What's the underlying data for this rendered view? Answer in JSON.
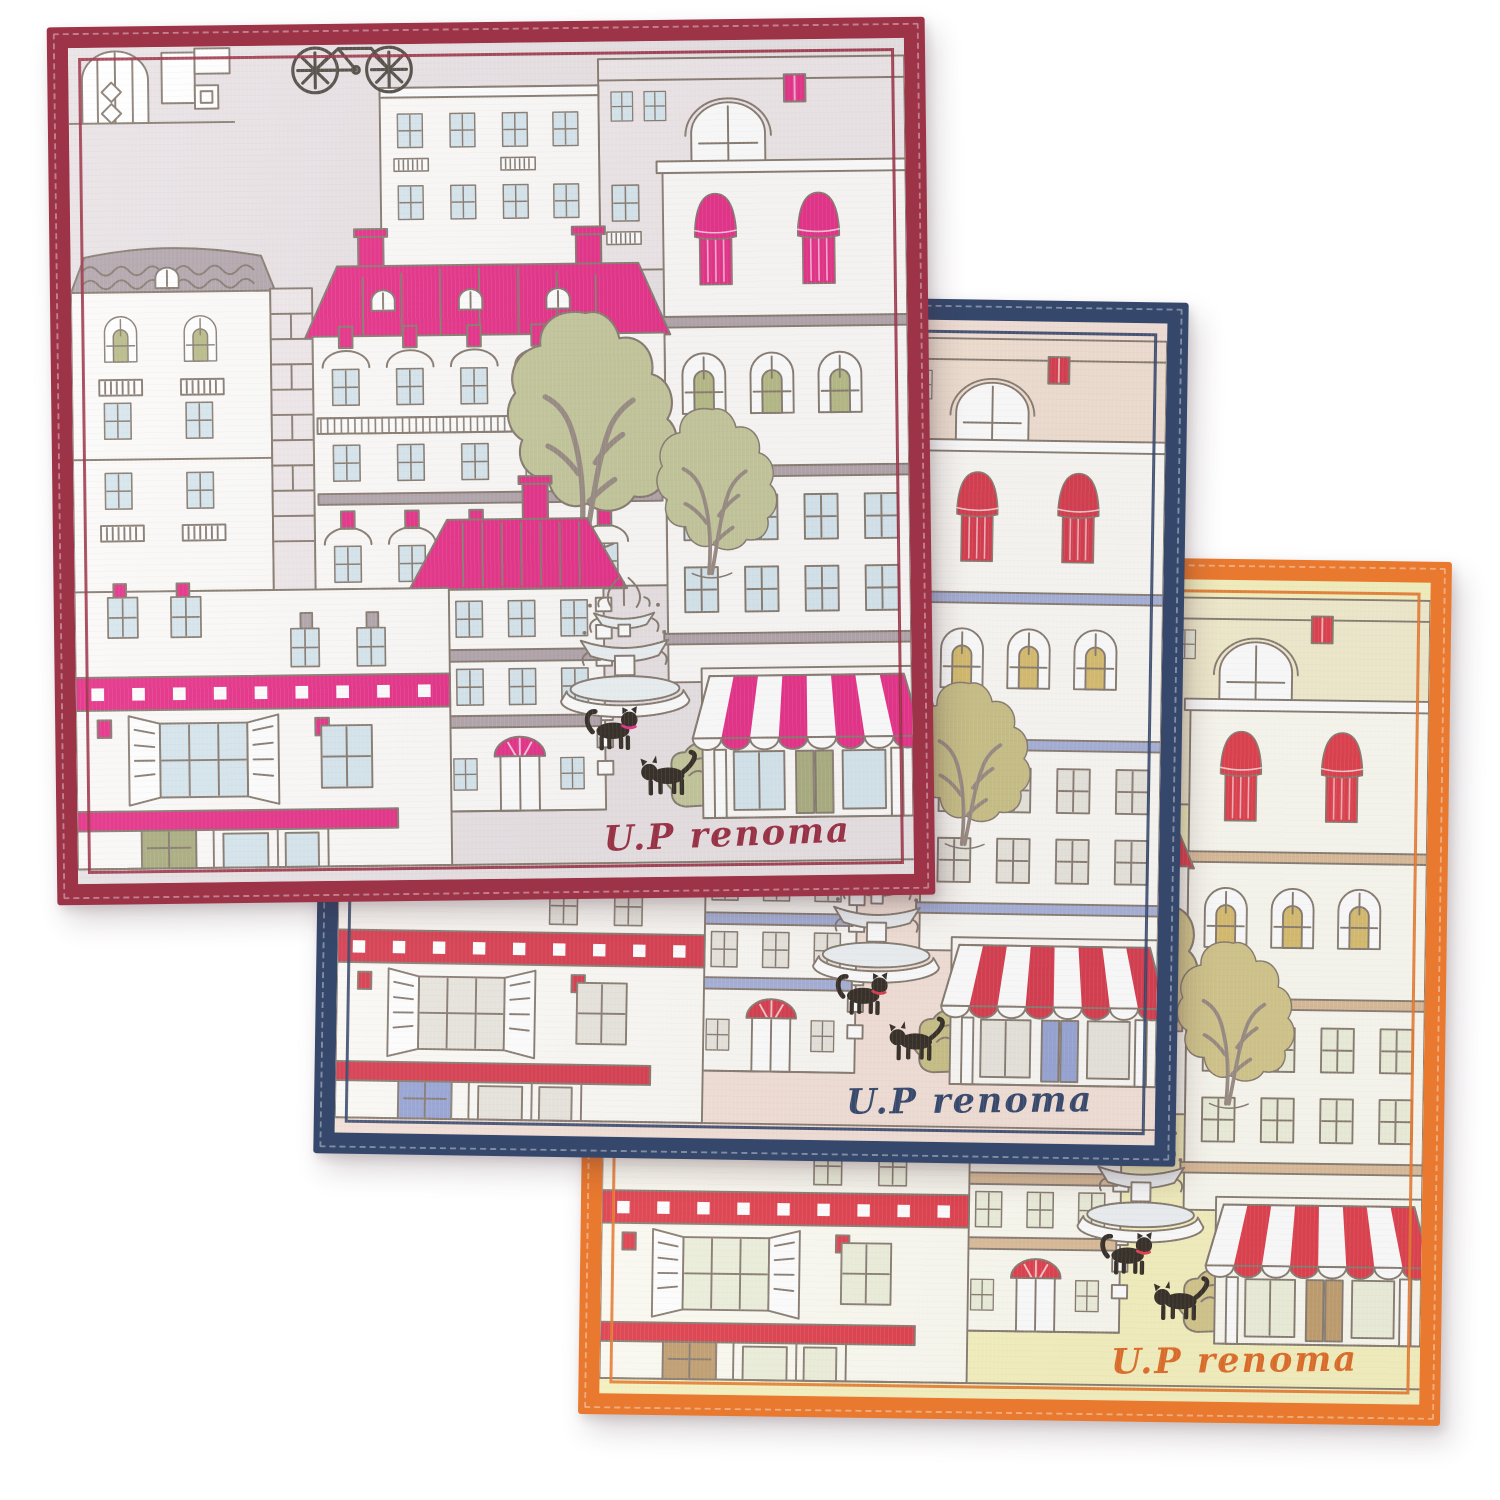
{
  "product_photo": {
    "brand_signature": "U.P renoma",
    "pattern_motifs": [
      "parisian-townhouses",
      "mansard-roofs",
      "window-awnings",
      "street-trees",
      "tiered-fountain",
      "black-cats",
      "striped-shop-awning",
      "bicycle",
      "shopfronts"
    ],
    "shared_colors": {
      "photobg": "#ffffff",
      "outline": "#8a7e74",
      "cat": "#3a322b",
      "wheel": "#57504a"
    },
    "handkerchiefs": [
      {
        "name": "grey-handkerchief-burgundy-trim",
        "position": "top-left",
        "brand_label": "U.P renoma",
        "colors": {
          "background": "#e9e3e6",
          "border": "#9d3347",
          "brand": "#9d3347",
          "accent": "#e7368c",
          "accent2": "#e7368c",
          "ledge": "#b4a8ae",
          "glass": "#d8e7ef",
          "lit": "#b9bd8a",
          "tree": "#c6c99e",
          "door": "#adb083",
          "facade": "#fcfbf9",
          "facade2": "#efe8ea",
          "water": "#edf3f6"
        }
      },
      {
        "name": "pink-handkerchief-navy-trim",
        "position": "middle",
        "brand_label": "U.P renoma",
        "colors": {
          "background": "#f4e2d9",
          "border": "#35476b",
          "brand": "#3a4c70",
          "accent": "#d84052",
          "accent2": "#d84052",
          "ledge": "#a9b2d9",
          "glass": "#e9e6df",
          "lit": "#d9bf72",
          "tree": "#cbc28a",
          "door": "#9aa7d6",
          "facade": "#fcfaf6",
          "facade2": "#f1e1d3",
          "water": "#eef2f4"
        }
      },
      {
        "name": "yellow-handkerchief-orange-trim",
        "position": "bottom-right",
        "brand_label": "U.P renoma",
        "colors": {
          "background": "#f6f2c0",
          "border": "#e8792f",
          "brand": "#e0702c",
          "accent": "#e04350",
          "accent2": "#e04350",
          "ledge": "#dcbe9b",
          "glass": "#eef0dd",
          "lit": "#d9bf72",
          "tree": "#d4c88e",
          "door": "#c2a072",
          "facade": "#fcfbf2",
          "facade2": "#f3edcf",
          "water": "#eef2f4"
        }
      }
    ]
  }
}
